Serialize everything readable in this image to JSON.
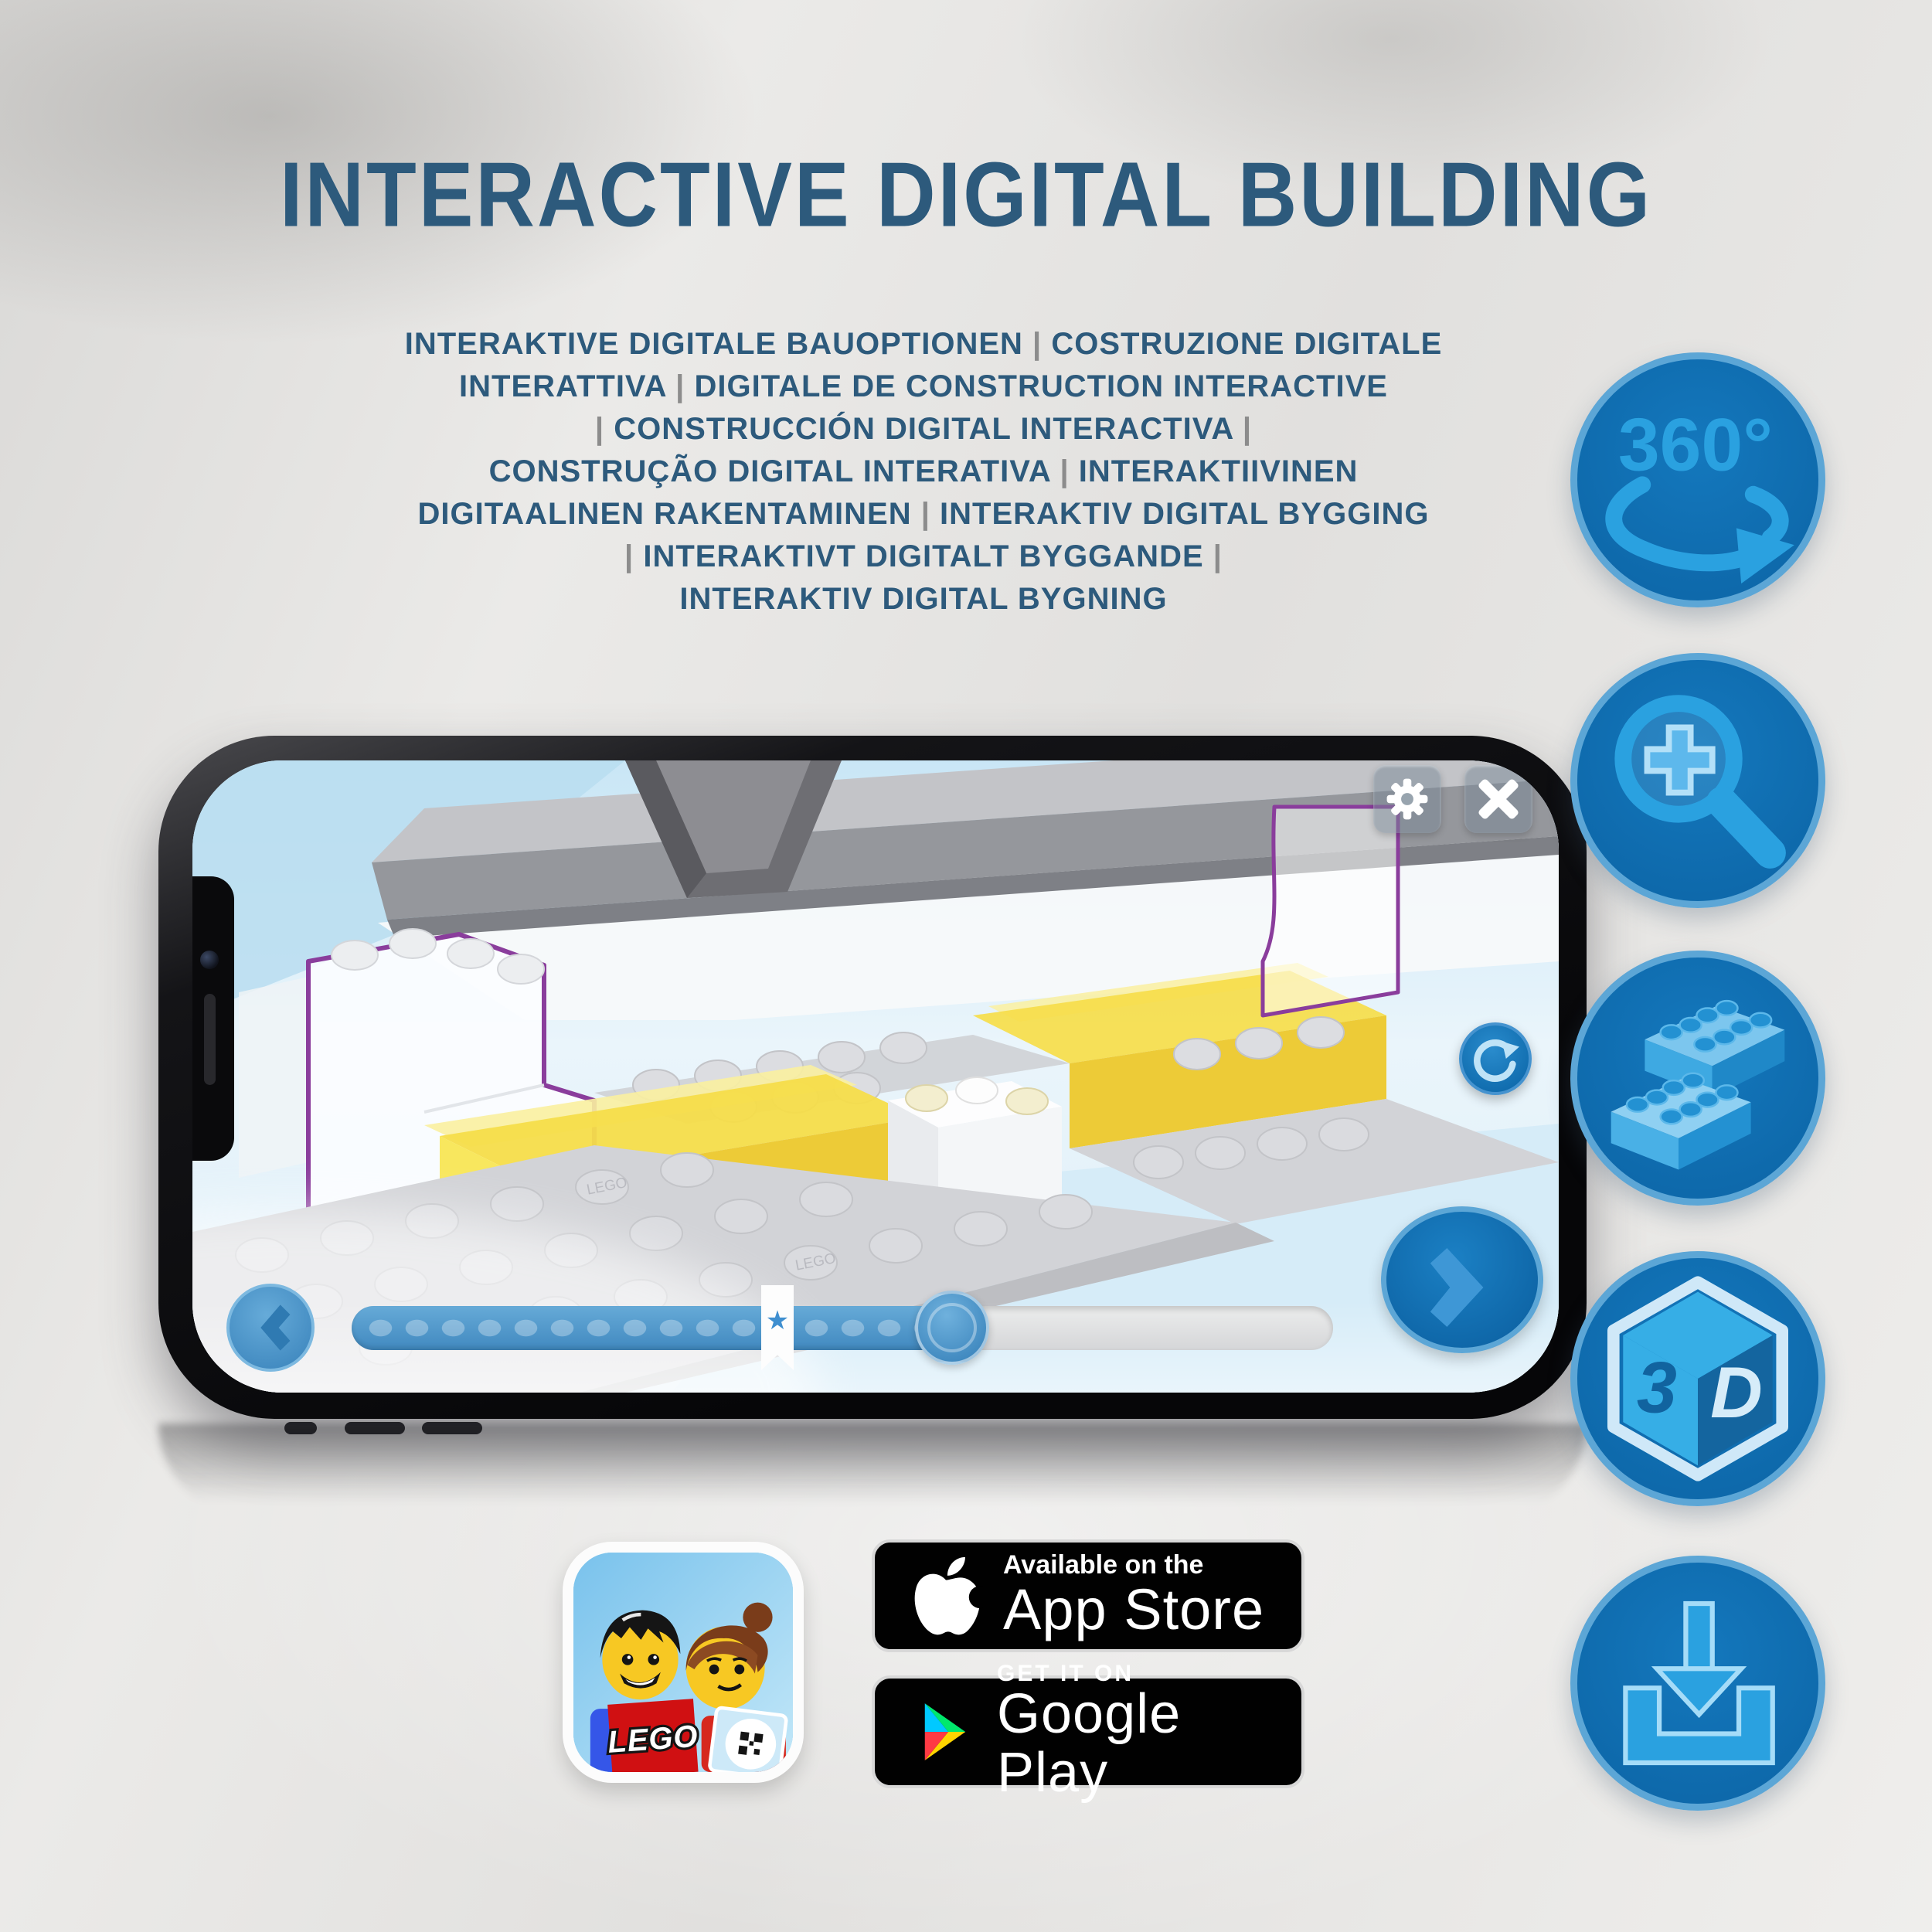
{
  "title": "INTERACTIVE DIGITAL BUILDING",
  "subtitle": {
    "lines": [
      "INTERAKTIVE DIGITALE BAUOPTIONEN | COSTRUZIONE DIGITALE",
      "INTERATTIVA | DIGITALE DE CONSTRUCTION INTERACTIVE",
      "| CONSTRUCCIÓN DIGITAL INTERACTIVA |",
      "CONSTRUÇÃO DIGITAL INTERATIVA | INTERAKTIIVINEN",
      "DIGITAALINEN RAKENTAMINEN | INTERAKTIV DIGITAL BYGGING",
      "| INTERAKTIVT DIGITALT BYGGANDE |",
      "INTERAKTIV DIGITAL BYGNING"
    ]
  },
  "features": [
    {
      "name": "360-rotation",
      "label": "360°"
    },
    {
      "name": "zoom-in",
      "label": ""
    },
    {
      "name": "brick-building",
      "label": ""
    },
    {
      "name": "3d-view",
      "label_left": "3",
      "label_right": "D"
    },
    {
      "name": "download",
      "label": ""
    }
  ],
  "phone": {
    "stud_text": "LEGO",
    "bookmark_star": "★"
  },
  "badges": {
    "app_icon_logo": "LEGO",
    "app_store": {
      "tagline": "Available on the",
      "store": "App Store"
    },
    "google_play": {
      "tagline": "GET IT ON",
      "store": "Google Play"
    }
  },
  "colors": {
    "headline_blue": "#2d5a7c",
    "pipe_gray": "#8c8c8c",
    "icon_circle": "#0f6fb4",
    "icon_ring": "#5ca6d6",
    "icon_glyph": "#2aa1e0",
    "screen_blue": "#dff0f9",
    "slider_blue": "#4189c0",
    "yellow_brick": "#f6dd4a",
    "purple_outline": "#8a3d9c",
    "badge_black": "#010101"
  }
}
